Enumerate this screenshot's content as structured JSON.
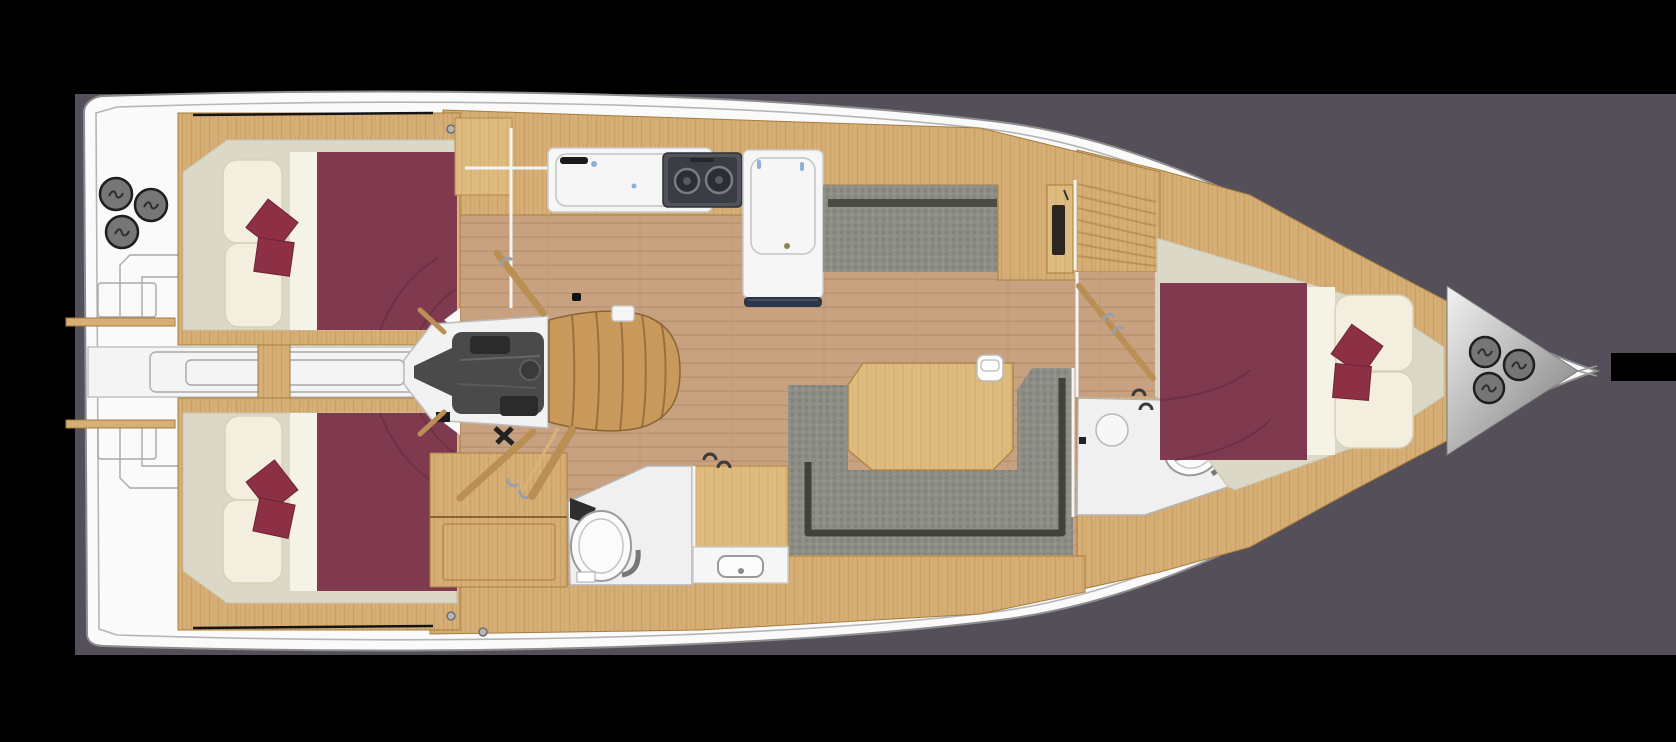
{
  "meta": {
    "description": "Top-down interior floor plan of a sailing yacht: three cabins with burgundy double berths, saloon with U-shaped settee and table, galley with stove and sinks, two heads with toilets, companionway steps, engine compartment, and deck winches at stern and bow",
    "type": "yacht-floor-plan",
    "orientation": "stern-left-bow-right"
  },
  "palette": {
    "canvas": "#000000",
    "backdrop": "#544f58",
    "black_bar": "#000000",
    "hull": "#fafafa",
    "hull_line": "#8d8d8d",
    "deck_line": "#b5b5b5",
    "wood": "#d7af76",
    "wood_dark": "#a57e3e",
    "wood_light": "#debb80",
    "sole": "#c8a181",
    "sole_line": "#b48e6b",
    "cabin_floor": "#dcd8c7",
    "bed": "#7f3a4f",
    "bed_seam": "#5f2a3c",
    "sheet": "#f5f2e6",
    "pillow": "#f3eedd",
    "cushion": "#8d3046",
    "sofa": "#8d8d85",
    "sofa_dark": "#4b4c45",
    "sofa_shadow": "#3c3c36",
    "table": "#d9b176",
    "steps": "#c9995c",
    "engine": "#4a4a4a",
    "engine_dark": "#2b2b2b",
    "alcove": "#f2f2f2",
    "counter": "#f6f6f6",
    "counter_line": "#cccccc",
    "stove": "#50545a",
    "stove_inner": "#3a3e44",
    "burner_ring": "#787d84",
    "rail_navy": "#2d3646",
    "head_floor": "#f0f0f0",
    "fixture_line": "#9a9a9a",
    "winch": "#767676",
    "winch_ring": "#1e1e1e",
    "bow_light": "#ededed",
    "bow_dark": "#8e8e8e",
    "door": "#b98f54",
    "handle_silver": "#9aa0a8",
    "handle_dark": "#3a3a3a",
    "accent_blue": "#8fb0d6",
    "top_shadow": "#141414"
  },
  "rooms": [
    {
      "name": "aft-cabin-starboard",
      "features": [
        "double-berth",
        "2 throw cushions",
        "seat cushions"
      ]
    },
    {
      "name": "aft-cabin-port",
      "features": [
        "double-berth",
        "2 throw cushions",
        "seat cushions"
      ]
    },
    {
      "name": "transom-passage",
      "features": [
        "stepped transom",
        "gear locker"
      ]
    },
    {
      "name": "engine-compartment",
      "features": [
        "engine"
      ]
    },
    {
      "name": "companionway",
      "features": [
        "curved wooden steps"
      ]
    },
    {
      "name": "galley",
      "features": [
        "sink",
        "2-burner stove",
        "refrigerator counter"
      ]
    },
    {
      "name": "saloon",
      "features": [
        "straight settee",
        "U-shaped settee",
        "dining table",
        "nav locker"
      ]
    },
    {
      "name": "aft-head",
      "features": [
        "toilet",
        "wash basin",
        "shower-wardrobe"
      ]
    },
    {
      "name": "forward-head",
      "features": [
        "toilet",
        "shower",
        "sliding door"
      ]
    },
    {
      "name": "forward-cabin",
      "features": [
        "V-berth",
        "2 throw cushions",
        "pillows"
      ]
    },
    {
      "name": "foredeck",
      "features": [
        "3 winches",
        "anchor bar"
      ]
    }
  ],
  "equipment": {
    "stern_winches": 3,
    "bow_winches": 3,
    "stove_burners": 2,
    "toilets": 2,
    "sinks": 3,
    "berths": 3
  }
}
